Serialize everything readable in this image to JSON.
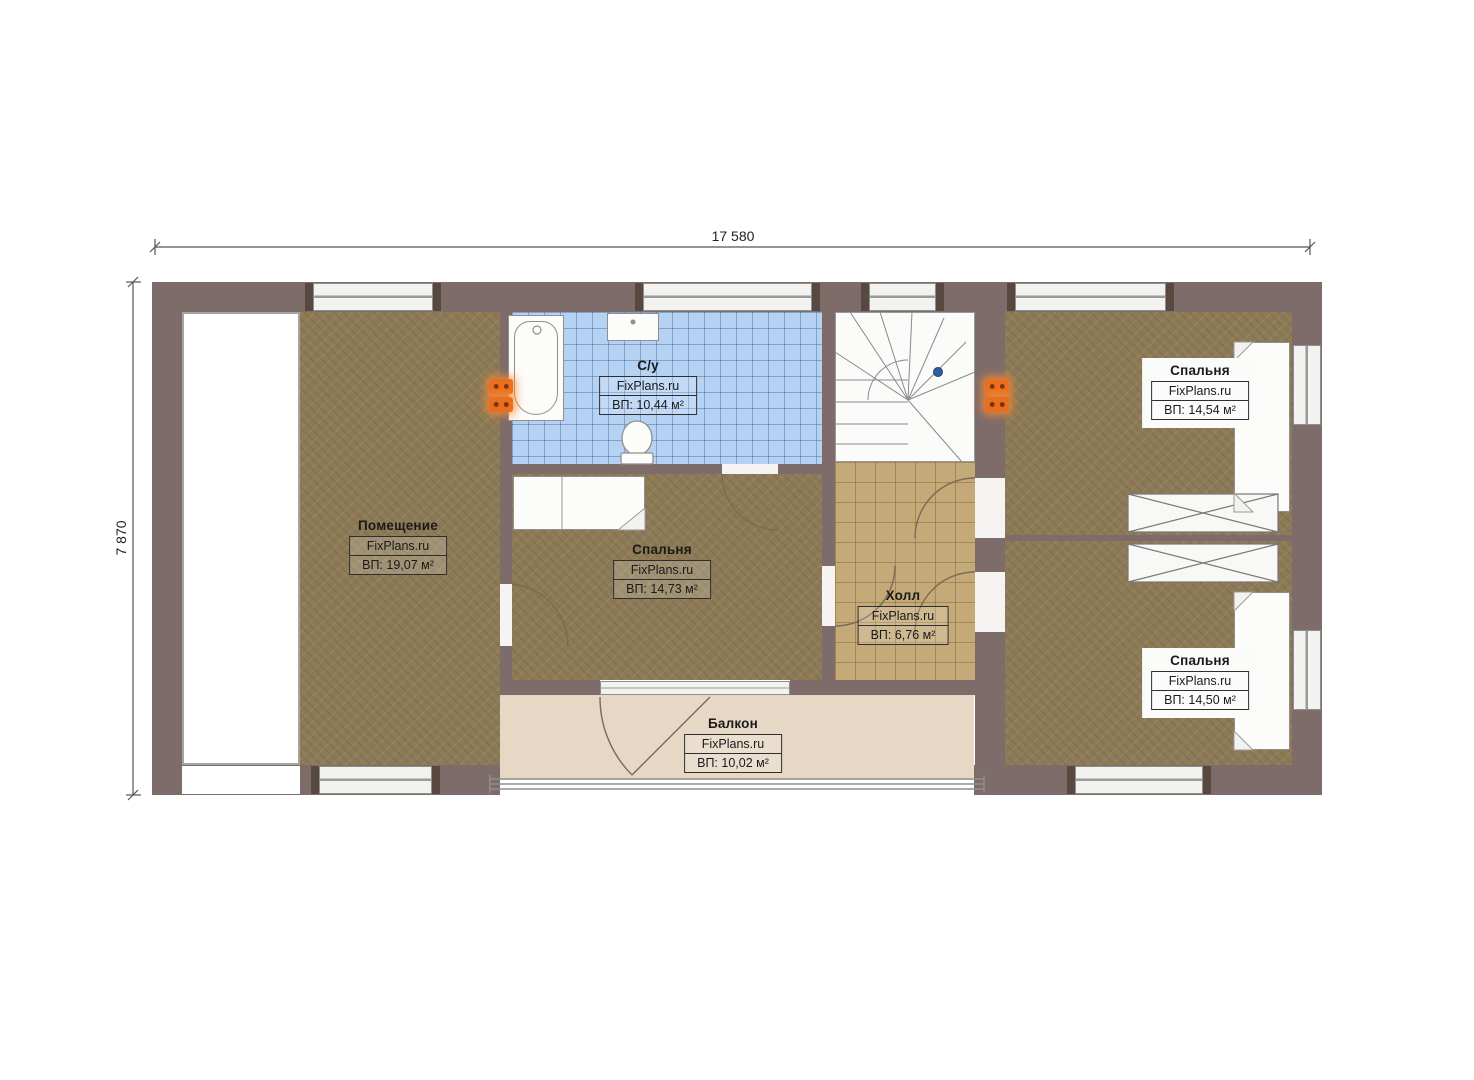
{
  "dimensions": {
    "width": "17 580",
    "height": "7 870"
  },
  "rooms": {
    "pomeshchenie": {
      "name": "Помещение",
      "brand": "FixPlans.ru",
      "area": "ВП: 19,07 м²"
    },
    "bathroom": {
      "name": "С/у",
      "brand": "FixPlans.ru",
      "area": "ВП: 10,44 м²"
    },
    "bedroom_mid": {
      "name": "Спальня",
      "brand": "FixPlans.ru",
      "area": "ВП: 14,73 м²"
    },
    "hall": {
      "name": "Холл",
      "brand": "FixPlans.ru",
      "area": "ВП: 6,76 м²"
    },
    "bedroom_top_right": {
      "name": "Спальня",
      "brand": "FixPlans.ru",
      "area": "ВП: 14,54 м²"
    },
    "bedroom_bottom_right": {
      "name": "Спальня",
      "brand": "FixPlans.ru",
      "area": "ВП: 14,50 м²"
    },
    "balcony": {
      "name": "Балкон",
      "brand": "FixPlans.ru",
      "area": "ВП: 10,02 м²"
    }
  },
  "colors": {
    "wall": "#7d6c6a",
    "carpet": "#8d7a56",
    "tile_bathroom": "#b5d2f3",
    "tile_hall": "#c5aa79",
    "balcony": "#e6d8c4",
    "radiator": "#e96f1f",
    "marker_blue": "#2f5f9e"
  }
}
